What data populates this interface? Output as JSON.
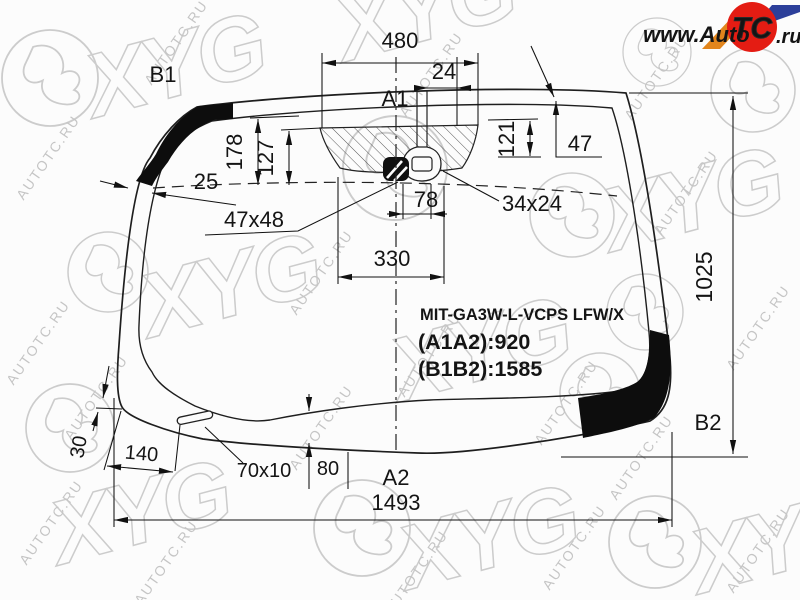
{
  "watermark": {
    "text": "AUTOTC.RU",
    "brand": "XYG"
  },
  "logo": {
    "www": "www.Auto",
    "tc": "TC",
    "ru": ".ru"
  },
  "labels": {
    "b1": "B1",
    "a1": "A1",
    "b2": "B2",
    "a2": "A2"
  },
  "part": {
    "number": "MIT-GA3W-L-VCPS LFW/X",
    "a1a2": "(A1A2):920",
    "b1b2": "(B1B2):1585"
  },
  "dims": {
    "d480": "480",
    "d24": "24",
    "d178": "178",
    "d127": "127",
    "d121": "121",
    "d47": "47",
    "d25": "25",
    "d47x48": "47x48",
    "d78": "78",
    "d34x24": "34x24",
    "d330": "330",
    "d1025": "1025",
    "d30": "30",
    "d140": "140",
    "d70x10": "70x10",
    "d80": "80",
    "d1493": "1493"
  }
}
